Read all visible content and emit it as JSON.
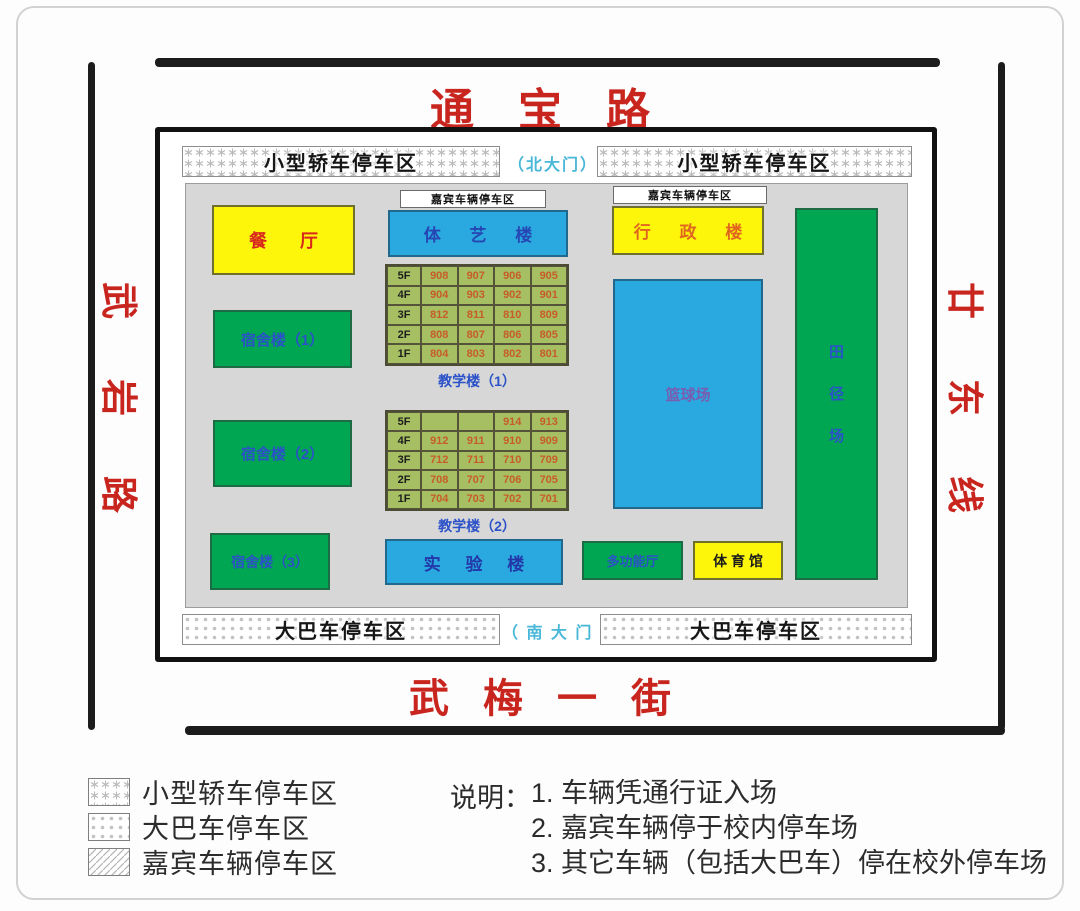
{
  "roads": {
    "top": "通宝路",
    "bottom": "武梅一街",
    "left": {
      "name": "武岩路",
      "chars": [
        "武",
        "岩",
        "路"
      ]
    },
    "right": {
      "name": "廿东线",
      "chars": [
        "廿",
        "东",
        "线"
      ]
    }
  },
  "gates": {
    "north": "（北大门）",
    "south": "（ 南 大 门 ）"
  },
  "parking_strips": {
    "top_left": "小型轿车停车区",
    "top_right": "小型轿车停车区",
    "bottom_left": "大巴车停车区",
    "bottom_right": "大巴车停车区"
  },
  "guest_parking_label": "嘉宾车辆停车区",
  "buildings": {
    "canteen": "餐  厅",
    "sports_arts": "体 艺 楼",
    "admin": "行 政 楼",
    "dorm1": "宿舍楼（1）",
    "dorm2": "宿舍楼（2）",
    "dorm3": "宿舍楼（3）",
    "lab": "实 验 楼",
    "basketball": "篮球场",
    "multifunction": "多功能厅",
    "gym": "体 育 馆",
    "track": {
      "name": "田径场",
      "chars": [
        "田",
        "径",
        "场"
      ]
    }
  },
  "teaching1": {
    "caption": "教学楼（1）",
    "rows": [
      {
        "floor": "5F",
        "rooms": [
          "908",
          "907",
          "906",
          "905"
        ]
      },
      {
        "floor": "4F",
        "rooms": [
          "904",
          "903",
          "902",
          "901"
        ]
      },
      {
        "floor": "3F",
        "rooms": [
          "812",
          "811",
          "810",
          "809"
        ]
      },
      {
        "floor": "2F",
        "rooms": [
          "808",
          "807",
          "806",
          "805"
        ]
      },
      {
        "floor": "1F",
        "rooms": [
          "804",
          "803",
          "802",
          "801"
        ]
      }
    ]
  },
  "teaching2": {
    "caption": "教学楼（2）",
    "rows": [
      {
        "floor": "5F",
        "rooms": [
          "",
          "",
          "914",
          "913"
        ]
      },
      {
        "floor": "4F",
        "rooms": [
          "912",
          "911",
          "910",
          "909"
        ]
      },
      {
        "floor": "3F",
        "rooms": [
          "712",
          "711",
          "710",
          "709"
        ]
      },
      {
        "floor": "2F",
        "rooms": [
          "708",
          "707",
          "706",
          "705"
        ]
      },
      {
        "floor": "1F",
        "rooms": [
          "704",
          "703",
          "702",
          "701"
        ]
      }
    ]
  },
  "legend": [
    {
      "pattern": "stars",
      "label": "小型轿车停车区"
    },
    {
      "pattern": "dots",
      "label": "大巴车停车区"
    },
    {
      "pattern": "hatch",
      "label": "嘉宾车辆停车区"
    }
  ],
  "notes": {
    "title": "说明：",
    "items": [
      "1. 车辆凭通行证入场",
      "2. 嘉宾车辆停于校内停车场",
      "3. 其它车辆（包括大巴车）停在校外停车场"
    ]
  },
  "colors": {
    "road_text": "#c9251f",
    "building_yellow": "#fdf60a",
    "building_blue": "#29a9e0",
    "building_green": "#00a651",
    "table_green": "#a6bf62",
    "room_number": "#c75c28",
    "gate_text": "#49b7d8",
    "label_blue": "#2b52c8"
  }
}
